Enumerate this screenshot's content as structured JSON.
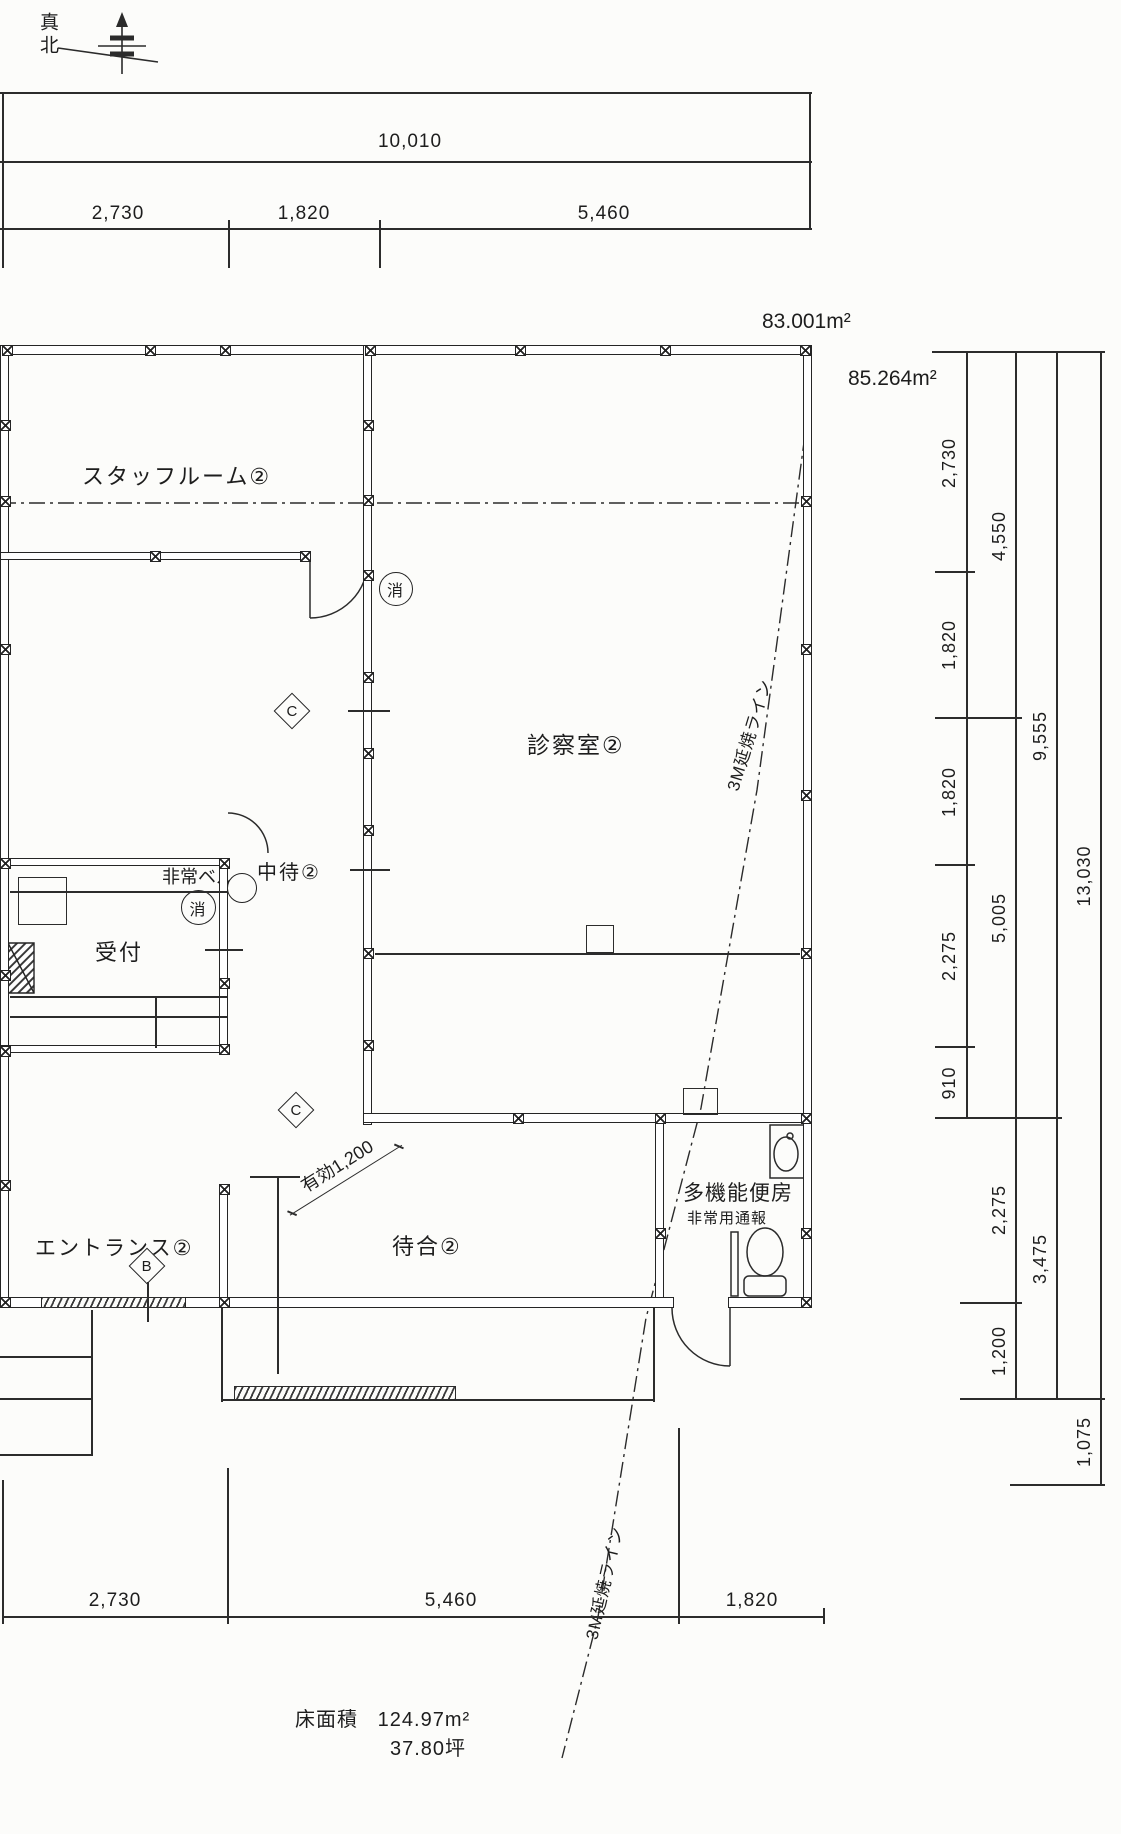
{
  "north": {
    "label": "真北"
  },
  "areas": {
    "upper": "83.001m²",
    "lower": "85.264m²"
  },
  "dims": {
    "top": {
      "total": "10,010",
      "segs": [
        "2,730",
        "1,820",
        "5,460"
      ]
    },
    "right": {
      "c1": [
        "2,730",
        "1,820",
        "1,820",
        "2,275",
        "910"
      ],
      "c2": [
        "4,550",
        "5,005",
        "2,275",
        "1,200"
      ],
      "c3": [
        "9,555",
        "3,475"
      ],
      "c4": [
        "13,030",
        "1,075"
      ]
    },
    "bottom": [
      "2,730",
      "5,460",
      "1,820"
    ]
  },
  "rooms": {
    "staff": "スタッフルーム②",
    "exam": "診察室②",
    "mid_wait": "中待②",
    "reception": "受付",
    "entrance": "エントランス②",
    "waiting": "待合②",
    "toilet": "多機能便房",
    "toilet_alarm": "非常用通報"
  },
  "ann": {
    "bell": "非常ベル",
    "extinguisher": "消",
    "clearance": "有効1,200",
    "fire_line": "3M延焼ライン",
    "diamond_c": "C",
    "diamond_b": "B"
  },
  "floor": {
    "label": "床面積",
    "value": "124.97m²",
    "tsubo": "37.80坪"
  }
}
